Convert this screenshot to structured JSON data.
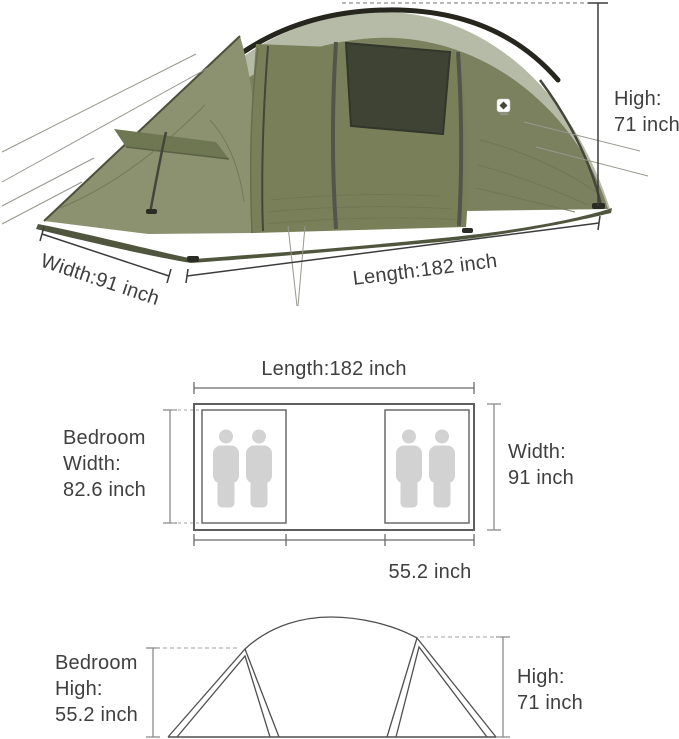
{
  "photo_section": {
    "high_label": {
      "line1": "High:",
      "line2": "71 inch"
    },
    "length_label": "Length:182 inch",
    "width_label": "Width:91 inch"
  },
  "floorplan_section": {
    "length_label": "Length:182 inch",
    "bedroom_width_label": {
      "line1": "Bedroom",
      "line2": "Width:",
      "line3": "82.6 inch"
    },
    "width_label": {
      "line1": "Width:",
      "line2": "91 inch"
    },
    "inner_width_label": "55.2 inch",
    "bedroom_count": 2,
    "persons_per_bedroom": 2
  },
  "profile_section": {
    "bedroom_high_label": {
      "line1": "Bedroom",
      "line2": "High:",
      "line3": "55.2 inch"
    },
    "high_label": {
      "line1": "High:",
      "line2": "71 inch"
    }
  },
  "dimensions": {
    "length_inch": 182,
    "width_inch": 91,
    "high_inch": 71,
    "bedroom_width_inch": 82.6,
    "bedroom_high_inch": 55.2,
    "inner_width_inch": 55.2
  },
  "colors": {
    "tent_olive": "#7b815f",
    "tent_vestibule": "#8c9170",
    "tent_sage": "#b6bba8",
    "tent_pole_black": "#26261f",
    "window_mesh": "#3e4334",
    "ground_tarp": "#50563d",
    "annotation_line": "#3c3c3c",
    "diagram_line": "#5e5e5e",
    "dash_line": "#b3b3b3",
    "person_gray": "#d2d2d2",
    "text": "#3f3f3f"
  }
}
